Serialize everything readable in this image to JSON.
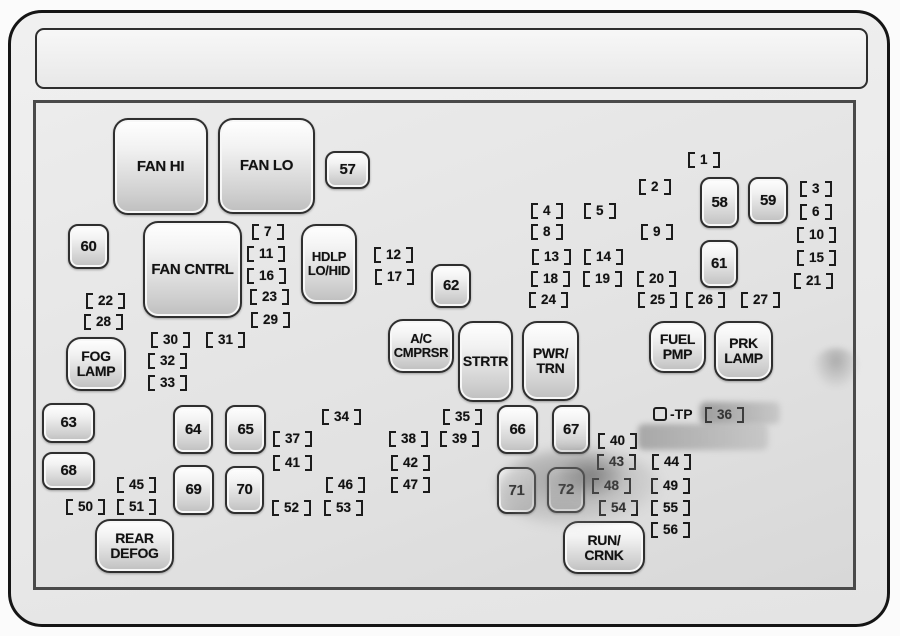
{
  "relays": {
    "fan_hi": "FAN HI",
    "fan_lo": "FAN LO",
    "fan_cntrl": "FAN CNTRL",
    "hdlp_lo_hid": "HDLP\nLO/HID",
    "ac_cmprsr": "A/C\nCMPRSR",
    "strtr": "STRTR",
    "pwr_trn": "PWR/\nTRN",
    "fuel_pmp": "FUEL\nPMP",
    "prk_lamp": "PRK\nLAMP",
    "fog_lamp": "FOG\nLAMP",
    "rear_defog": "REAR\nDEFOG",
    "run_crnk": "RUN/\nCRNK",
    "r57": "57",
    "r58": "58",
    "r59": "59",
    "r60": "60",
    "r61": "61",
    "r62": "62",
    "r63": "63",
    "r64": "64",
    "r65": "65",
    "r66": "66",
    "r67": "67",
    "r68": "68",
    "r69": "69",
    "r70": "70",
    "r71": "71",
    "r72": "72"
  },
  "fuses": {
    "f1": "1",
    "f2": "2",
    "f3": "3",
    "f4": "4",
    "f5": "5",
    "f6": "6",
    "f7": "7",
    "f8": "8",
    "f9": "9",
    "f10": "10",
    "f11": "11",
    "f12": "12",
    "f13": "13",
    "f14": "14",
    "f15": "15",
    "f16": "16",
    "f17": "17",
    "f18": "18",
    "f19": "19",
    "f20": "20",
    "f21": "21",
    "f22": "22",
    "f23": "23",
    "f24": "24",
    "f25": "25",
    "f26": "26",
    "f27": "27",
    "f28": "28",
    "f29": "29",
    "f30": "30",
    "f31": "31",
    "f32": "32",
    "f33": "33",
    "f34": "34",
    "f35": "35",
    "f36": "36",
    "f37": "37",
    "f38": "38",
    "f39": "39",
    "f40": "40",
    "f41": "41",
    "f42": "42",
    "f43": "43",
    "f44": "44",
    "f45": "45",
    "f46": "46",
    "f47": "47",
    "f48": "48",
    "f49": "49",
    "f50": "50",
    "f51": "51",
    "f52": "52",
    "f53": "53",
    "f54": "54",
    "f55": "55",
    "f56": "56"
  },
  "tp": {
    "label": "-TP"
  }
}
